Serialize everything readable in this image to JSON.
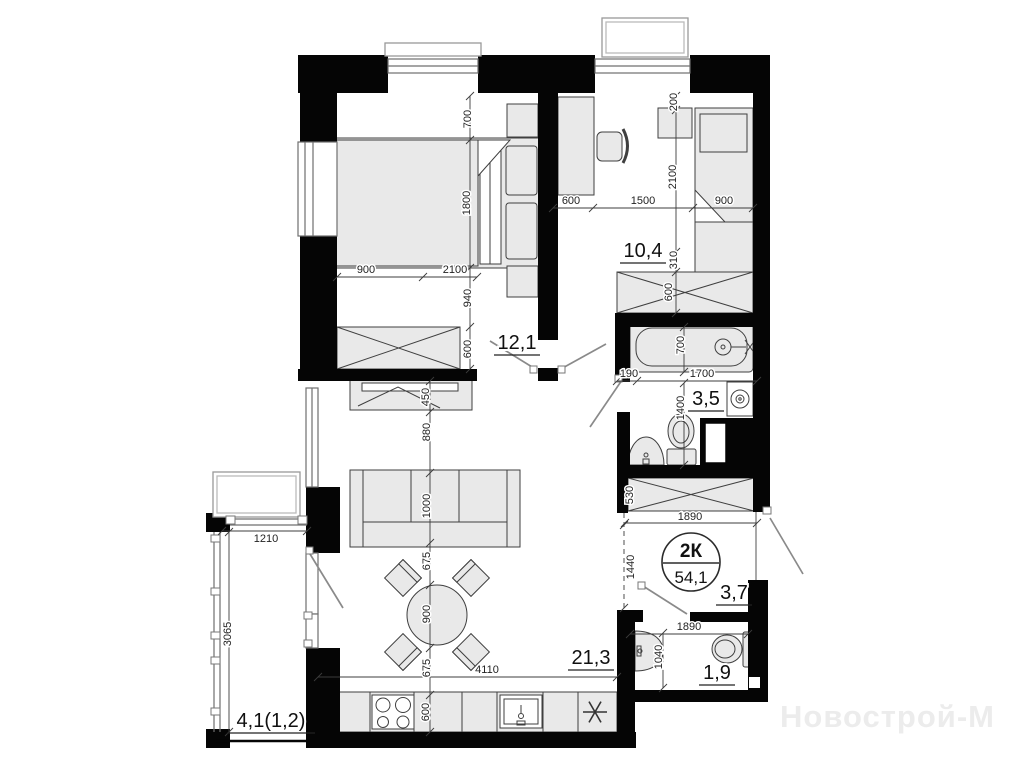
{
  "watermark": "Новострой-М",
  "badge": {
    "type": "2К",
    "area": "54,1"
  },
  "rooms": [
    {
      "name": "living-room",
      "area": "21,3",
      "x": 591,
      "y": 664,
      "w": 46
    },
    {
      "name": "bedroom-1",
      "area": "12,1",
      "x": 517,
      "y": 349,
      "w": 46
    },
    {
      "name": "bedroom-2",
      "area": "10,4",
      "x": 643,
      "y": 257,
      "w": 46
    },
    {
      "name": "bathroom",
      "area": "3,5",
      "x": 706,
      "y": 405,
      "w": 36
    },
    {
      "name": "wc",
      "area": "1,9",
      "x": 717,
      "y": 679,
      "w": 36
    },
    {
      "name": "entry-hall",
      "area": "3,7",
      "x": 734,
      "y": 599,
      "w": 36
    },
    {
      "name": "balcony",
      "area": "4,1(1,2)",
      "x": 271,
      "y": 727,
      "w": 88
    }
  ],
  "dimensions": [
    {
      "t": "700",
      "x": 471,
      "y": 119,
      "r": -90
    },
    {
      "t": "1800",
      "x": 470,
      "y": 203,
      "r": -90
    },
    {
      "t": "940",
      "x": 471,
      "y": 298,
      "r": -90
    },
    {
      "t": "600",
      "x": 471,
      "y": 349,
      "r": -90
    },
    {
      "t": "900",
      "x": 366,
      "y": 273,
      "r": 0
    },
    {
      "t": "2100",
      "x": 455,
      "y": 273,
      "r": 0
    },
    {
      "t": "450",
      "x": 429,
      "y": 397,
      "r": -90
    },
    {
      "t": "880",
      "x": 430,
      "y": 432,
      "r": -90
    },
    {
      "t": "1000",
      "x": 430,
      "y": 506,
      "r": -90
    },
    {
      "t": "675",
      "x": 430,
      "y": 561,
      "r": -90
    },
    {
      "t": "900",
      "x": 430,
      "y": 614,
      "r": -90
    },
    {
      "t": "675",
      "x": 430,
      "y": 668,
      "r": -90
    },
    {
      "t": "600",
      "x": 429,
      "y": 712,
      "r": -90
    },
    {
      "t": "4110",
      "x": 487,
      "y": 673,
      "r": 0
    },
    {
      "t": "600",
      "x": 571,
      "y": 204,
      "r": 0
    },
    {
      "t": "1500",
      "x": 643,
      "y": 204,
      "r": 0
    },
    {
      "t": "900",
      "x": 724,
      "y": 204,
      "r": 0
    },
    {
      "t": "200",
      "x": 677,
      "y": 102,
      "r": -90
    },
    {
      "t": "2100",
      "x": 676,
      "y": 177,
      "r": -90
    },
    {
      "t": "310",
      "x": 677,
      "y": 260,
      "r": -90
    },
    {
      "t": "600",
      "x": 672,
      "y": 292,
      "r": -90
    },
    {
      "t": "190",
      "x": 629,
      "y": 377,
      "r": 0
    },
    {
      "t": "1700",
      "x": 702,
      "y": 377,
      "r": 0
    },
    {
      "t": "700",
      "x": 684,
      "y": 345,
      "r": -90
    },
    {
      "t": "1400",
      "x": 684,
      "y": 408,
      "r": -90
    },
    {
      "t": "530",
      "x": 633,
      "y": 495,
      "r": -90
    },
    {
      "t": "1890",
      "x": 690,
      "y": 520,
      "r": 0
    },
    {
      "t": "1440",
      "x": 634,
      "y": 567,
      "r": -90
    },
    {
      "t": "1890",
      "x": 689,
      "y": 630,
      "r": 0
    },
    {
      "t": "1040",
      "x": 662,
      "y": 657,
      "r": -90
    },
    {
      "t": "1210",
      "x": 266,
      "y": 542,
      "r": 0
    },
    {
      "t": "3065",
      "x": 231,
      "y": 634,
      "r": -90
    }
  ],
  "colors": {
    "wall": "#050505",
    "furniture_fill": "#e9e9e9",
    "dim_text": "#222222",
    "label_text": "#101010",
    "watermark": "#ececec"
  }
}
